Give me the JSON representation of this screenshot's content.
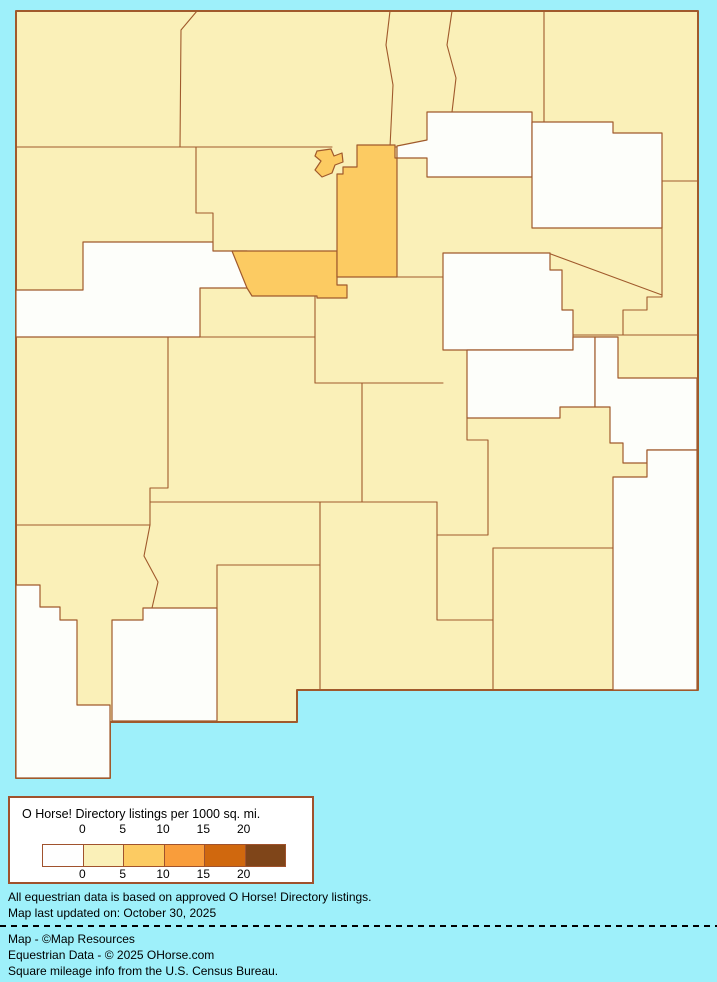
{
  "page": {
    "background_color": "#9EF0FA"
  },
  "legend": {
    "title": "O Horse! Directory listings per 1000 sq. mi.",
    "tick_labels": [
      "0",
      "5",
      "10",
      "15",
      "20"
    ],
    "colors": [
      "#FEFEFE",
      "#FAF0B8",
      "#FCCB62",
      "#F99D3B",
      "#D0680E",
      "#7F4519"
    ],
    "border_color": "#A0522D"
  },
  "footnotes": [
    "All equestrian data is based on approved O Horse! Directory listings.",
    "Map last updated on: October 30, 2025"
  ],
  "credits": [
    "Map - ©Map Resources",
    "Equestrian Data - © 2025 OHorse.com",
    "Square mileage info from the U.S. Census Bureau."
  ],
  "map": {
    "region": "New Mexico counties choropleth",
    "border_color": "#A05A2C",
    "default_level": "0-5",
    "level_fills": {
      "0": "#FDFEFA",
      "0-5": "#FAF0B8",
      "5-10": "#FCCB62"
    },
    "state_outline": [
      [
        16,
        11
      ],
      [
        698,
        11
      ],
      [
        698,
        690
      ],
      [
        297,
        690
      ],
      [
        297,
        722
      ],
      [
        110,
        722
      ],
      [
        110,
        778
      ],
      [
        16,
        778
      ]
    ],
    "counties": [
      {
        "id": "cibola",
        "level": "0",
        "points": [
          [
            83,
            242
          ],
          [
            213,
            242
          ],
          [
            213,
            251
          ],
          [
            247,
            251
          ],
          [
            247,
            288
          ],
          [
            200,
            288
          ],
          [
            200,
            337
          ],
          [
            16,
            337
          ],
          [
            16,
            290
          ],
          [
            83,
            290
          ]
        ]
      },
      {
        "id": "mora",
        "level": "0",
        "points": [
          [
            427,
            112
          ],
          [
            532,
            112
          ],
          [
            532,
            177
          ],
          [
            427,
            177
          ],
          [
            427,
            158
          ],
          [
            397,
            158
          ],
          [
            397,
            146
          ],
          [
            427,
            140
          ]
        ]
      },
      {
        "id": "harding",
        "level": "0",
        "points": [
          [
            532,
            122
          ],
          [
            613,
            122
          ],
          [
            613,
            133
          ],
          [
            662,
            133
          ],
          [
            662,
            228
          ],
          [
            532,
            228
          ]
        ]
      },
      {
        "id": "guadalupe",
        "level": "0",
        "points": [
          [
            443,
            253
          ],
          [
            550,
            253
          ],
          [
            550,
            270
          ],
          [
            562,
            270
          ],
          [
            562,
            310
          ],
          [
            573,
            310
          ],
          [
            573,
            350
          ],
          [
            443,
            350
          ]
        ]
      },
      {
        "id": "de-baca",
        "level": "0",
        "points": [
          [
            467,
            350
          ],
          [
            573,
            350
          ],
          [
            573,
            337
          ],
          [
            595,
            337
          ],
          [
            595,
            407
          ],
          [
            560,
            407
          ],
          [
            560,
            418
          ],
          [
            467,
            418
          ]
        ]
      },
      {
        "id": "roosevelt",
        "level": "0",
        "points": [
          [
            595,
            337
          ],
          [
            618,
            337
          ],
          [
            618,
            378
          ],
          [
            697,
            378
          ],
          [
            697,
            450
          ],
          [
            647,
            450
          ],
          [
            647,
            463
          ],
          [
            623,
            463
          ],
          [
            623,
            443
          ],
          [
            610,
            443
          ],
          [
            610,
            407
          ],
          [
            595,
            407
          ]
        ]
      },
      {
        "id": "lea",
        "level": "0",
        "points": [
          [
            647,
            450
          ],
          [
            697,
            450
          ],
          [
            697,
            690
          ],
          [
            613,
            690
          ],
          [
            613,
            477
          ],
          [
            647,
            477
          ]
        ]
      },
      {
        "id": "luna",
        "level": "0",
        "points": [
          [
            112,
            620
          ],
          [
            143,
            620
          ],
          [
            143,
            608
          ],
          [
            217,
            608
          ],
          [
            217,
            721
          ],
          [
            112,
            721
          ]
        ]
      },
      {
        "id": "hidalgo",
        "level": "0",
        "points": [
          [
            16,
            585
          ],
          [
            40,
            585
          ],
          [
            40,
            607
          ],
          [
            60,
            607
          ],
          [
            60,
            620
          ],
          [
            77,
            620
          ],
          [
            77,
            705
          ],
          [
            110,
            705
          ],
          [
            110,
            778
          ],
          [
            16,
            778
          ]
        ]
      },
      {
        "id": "bernalillo",
        "level": "5-10",
        "points": [
          [
            232,
            251
          ],
          [
            337,
            251
          ],
          [
            337,
            285
          ],
          [
            347,
            285
          ],
          [
            347,
            298
          ],
          [
            317,
            298
          ],
          [
            317,
            296
          ],
          [
            252,
            296
          ],
          [
            247,
            288
          ]
        ]
      },
      {
        "id": "santa-fe",
        "level": "5-10",
        "points": [
          [
            357,
            145
          ],
          [
            395,
            145
          ],
          [
            395,
            158
          ],
          [
            397,
            158
          ],
          [
            397,
            277
          ],
          [
            337,
            277
          ],
          [
            337,
            174
          ],
          [
            343,
            174
          ],
          [
            343,
            167
          ],
          [
            357,
            167
          ]
        ]
      },
      {
        "id": "los-alamos",
        "level": "5-10",
        "points": [
          [
            317,
            151
          ],
          [
            331,
            149
          ],
          [
            334,
            156
          ],
          [
            342,
            153
          ],
          [
            343,
            162
          ],
          [
            335,
            165
          ],
          [
            332,
            173
          ],
          [
            322,
            177
          ],
          [
            315,
            170
          ],
          [
            321,
            161
          ],
          [
            315,
            156
          ]
        ]
      }
    ],
    "interior_borders": [
      [
        [
          16,
          147
        ],
        [
          332,
          147
        ]
      ],
      [
        [
          197,
          11
        ],
        [
          181,
          30
        ],
        [
          180,
          147
        ]
      ],
      [
        [
          196,
          147
        ],
        [
          196,
          213
        ],
        [
          213,
          213
        ],
        [
          213,
          242
        ]
      ],
      [
        [
          390,
          11
        ],
        [
          386,
          45
        ],
        [
          393,
          85
        ],
        [
          390,
          147
        ]
      ],
      [
        [
          452,
          11
        ],
        [
          447,
          45
        ],
        [
          456,
          78
        ],
        [
          452,
          112
        ]
      ],
      [
        [
          544,
          11
        ],
        [
          544,
          122
        ]
      ],
      [
        [
          390,
          147
        ],
        [
          427,
          147
        ]
      ],
      [
        [
          16,
          525
        ],
        [
          150,
          525
        ]
      ],
      [
        [
          168,
          337
        ],
        [
          168,
          488
        ],
        [
          150,
          488
        ],
        [
          150,
          525
        ]
      ],
      [
        [
          150,
          525
        ],
        [
          144,
          556
        ],
        [
          158,
          582
        ],
        [
          152,
          608
        ]
      ],
      [
        [
          200,
          337
        ],
        [
          315,
          337
        ]
      ],
      [
        [
          315,
          277
        ],
        [
          315,
          383
        ]
      ],
      [
        [
          397,
          277
        ],
        [
          443,
          277
        ]
      ],
      [
        [
          315,
          383
        ],
        [
          443,
          383
        ]
      ],
      [
        [
          362,
          383
        ],
        [
          362,
          502
        ]
      ],
      [
        [
          150,
          502
        ],
        [
          437,
          502
        ]
      ],
      [
        [
          320,
          502
        ],
        [
          320,
          690
        ]
      ],
      [
        [
          217,
          565
        ],
        [
          320,
          565
        ]
      ],
      [
        [
          217,
          565
        ],
        [
          217,
          608
        ]
      ],
      [
        [
          467,
          418
        ],
        [
          467,
          440
        ],
        [
          488,
          440
        ],
        [
          488,
          535
        ],
        [
          437,
          535
        ],
        [
          437,
          502
        ]
      ],
      [
        [
          437,
          535
        ],
        [
          437,
          620
        ],
        [
          493,
          620
        ]
      ],
      [
        [
          493,
          548
        ],
        [
          493,
          690
        ]
      ],
      [
        [
          493,
          548
        ],
        [
          613,
          548
        ]
      ],
      [
        [
          662,
          181
        ],
        [
          698,
          181
        ]
      ],
      [
        [
          662,
          181
        ],
        [
          662,
          247
        ]
      ],
      [
        [
          548,
          253
        ],
        [
          662,
          295
        ]
      ],
      [
        [
          560,
          335
        ],
        [
          623,
          335
        ],
        [
          623,
          310
        ],
        [
          647,
          310
        ],
        [
          647,
          297
        ],
        [
          662,
          297
        ],
        [
          662,
          247
        ]
      ],
      [
        [
          618,
          335
        ],
        [
          698,
          335
        ]
      ]
    ]
  }
}
